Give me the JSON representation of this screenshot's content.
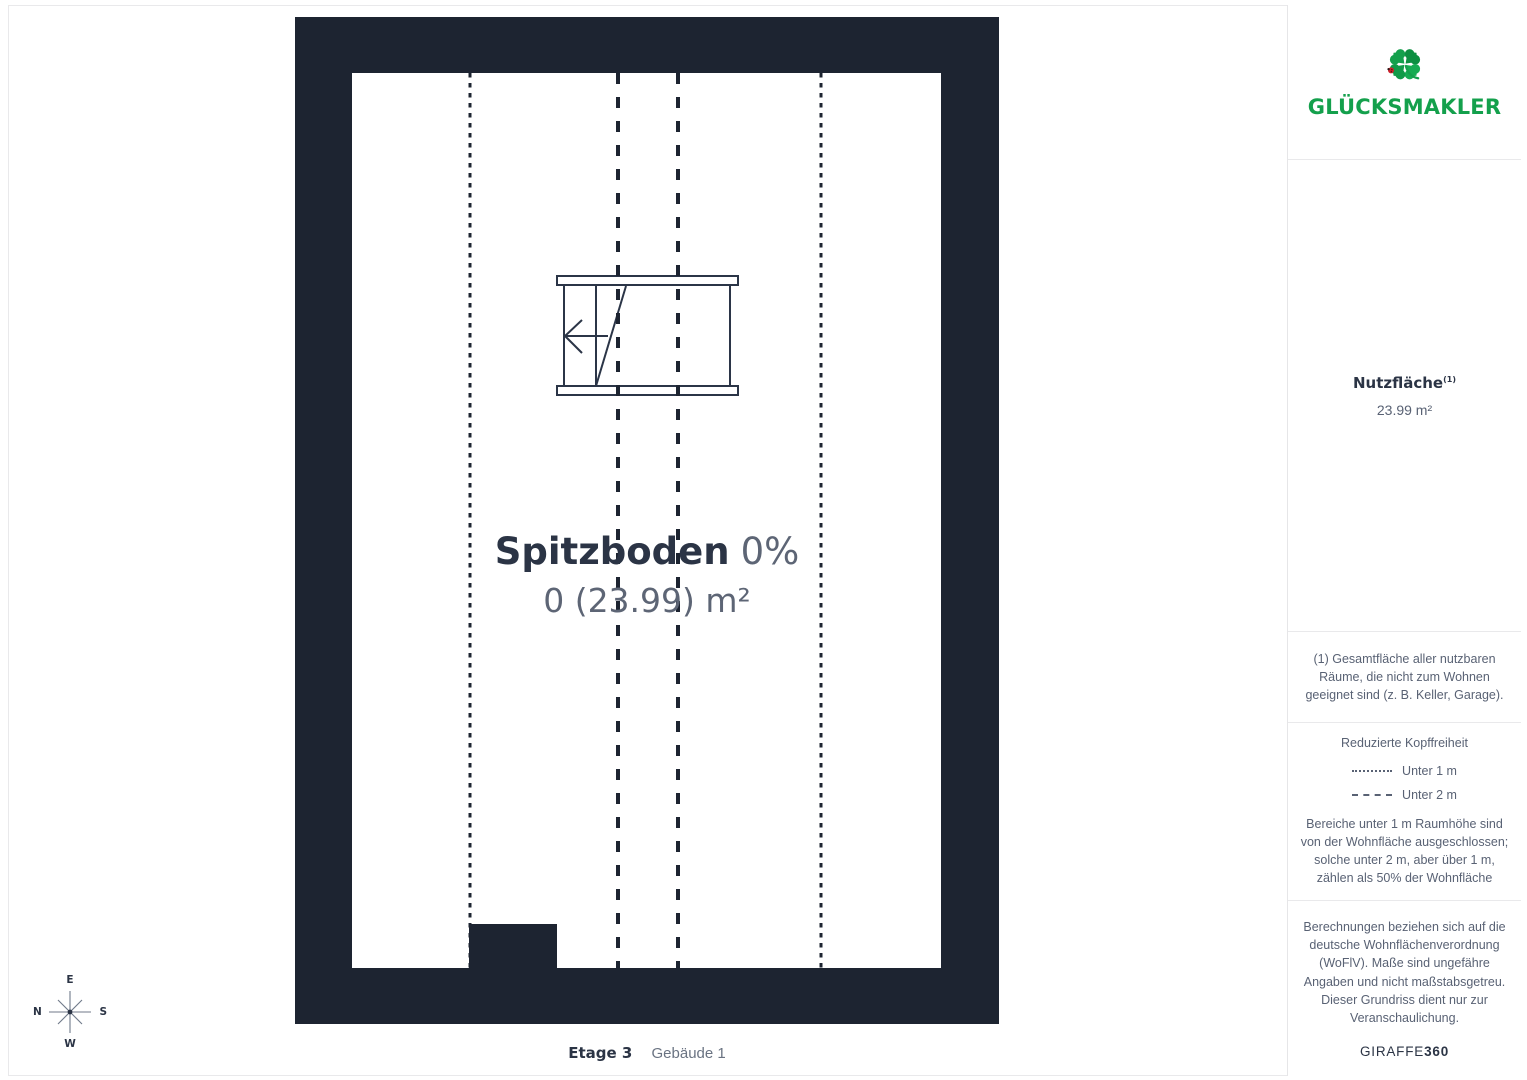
{
  "plan": {
    "room": {
      "name": "Spitzboden",
      "percent": "0%",
      "area": "0 (23.99) m²"
    },
    "compass": {
      "top": "E",
      "left": "N",
      "right": "S",
      "bottom": "W"
    }
  },
  "footer": {
    "floor_label": "Etage 3",
    "building_label": "Gebäude 1"
  },
  "sidebar": {
    "brand": {
      "name": "GLÜCKSMAKLER",
      "logo_icon": "four-leaf-clover-icon",
      "logo_detail_icon": "ladybug-icon"
    },
    "area_section": {
      "label": "Nutzfläche",
      "superscript": "(1)",
      "value": "23.99 m²"
    },
    "footnote": "(1) Gesamtfläche aller nutzbaren Räume, die nicht zum Wohnen geeignet sind (z. B. Keller, Garage).",
    "legend": {
      "title": "Reduzierte Kopffreiheit",
      "items": [
        {
          "style": "dotted",
          "label": "Unter 1 m"
        },
        {
          "style": "dashed",
          "label": "Unter 2 m"
        }
      ],
      "note": "Bereiche unter 1 m Raumhöhe sind von der Wohnfläche ausgeschlossen; solche unter 2 m, aber über 1 m, zählen als 50% der Wohnfläche"
    },
    "disclaimer": "Berechnungen beziehen sich auf die deutsche Wohnflächenverordnung (WoFlV). Maße sind ungefähre Angaben und nicht maßstabsgetreu. Dieser Grundriss dient nur zur Veranschaulichung.",
    "watermark": {
      "regular": "GIRAFFE",
      "bold": "360"
    }
  },
  "colors": {
    "wall": "#1d2431",
    "brand_green": "#14a04c",
    "text_dark": "#2b3445",
    "text_gray": "#596274"
  }
}
